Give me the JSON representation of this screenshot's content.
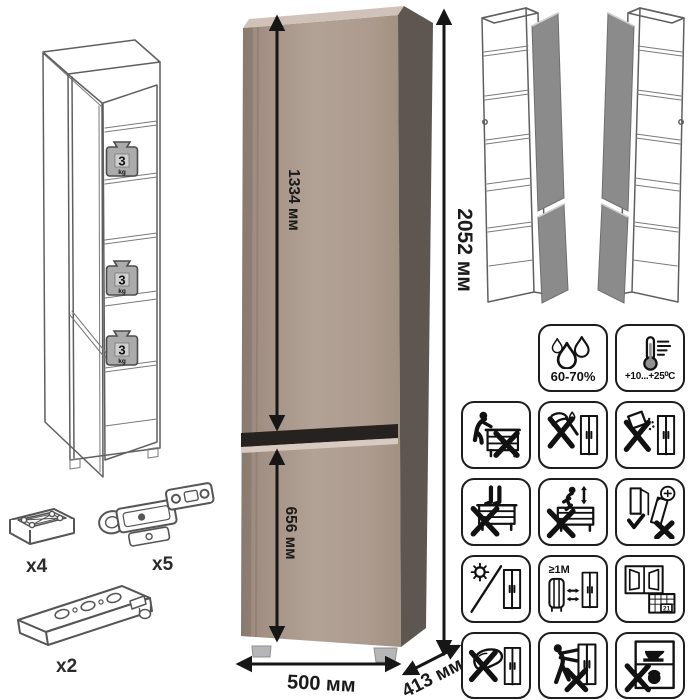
{
  "dimensions": {
    "upper_door_height": "1334 мм",
    "total_height": "2052 мм",
    "lower_door_height": "656 мм",
    "width": "500 мм",
    "depth": "413 мм"
  },
  "shelf_load": {
    "value": "3",
    "unit": "kg"
  },
  "hardware": {
    "foot": {
      "label": "x4"
    },
    "hinge": {
      "label": "x5"
    },
    "rail": {
      "label": "x2"
    }
  },
  "climate": {
    "humidity": "60-70%",
    "temperature": "+10...+25⁰C"
  },
  "care": {
    "heat_distance": "≥1М",
    "calendar_day": "21",
    "icons": [
      "humidity-60-70",
      "temperature-plus10-plus25",
      "no-sitting",
      "no-sharp-tools",
      "no-spilling",
      "no-standing",
      "no-jumping",
      "anchor-to-wall",
      "avoid-direct-sunlight",
      "keep-1m-from-heat-source",
      "ventilate-room",
      "no-abrasive-cleaning",
      "no-dragging",
      "no-heavy-items"
    ]
  },
  "colors": {
    "cabinet_front": "#ab9a8d",
    "cabinet_side": "#5e5751",
    "cabinet_top": "#d0c2b8",
    "door_gap": "#26221f",
    "gap_highlight": "#d8cac1",
    "open_door_gray": "#8b8b8b",
    "line_art": "#5f5f5f",
    "pictogram": "#111111"
  }
}
